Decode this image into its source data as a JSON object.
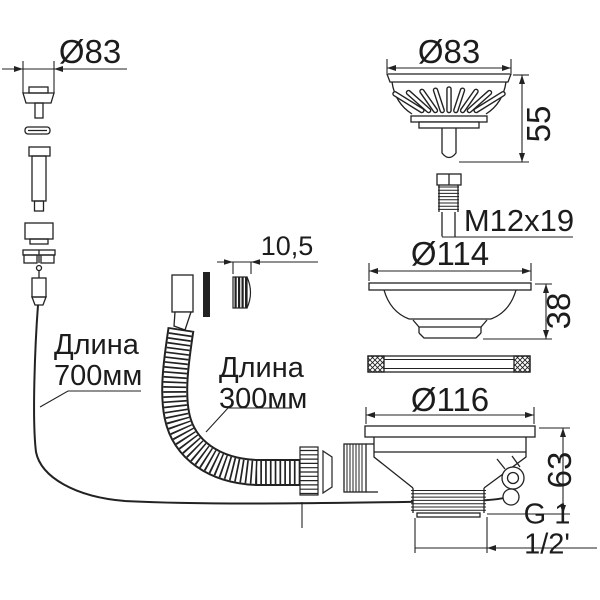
{
  "drawing": {
    "title_hint": "sink drain kit technical drawing",
    "background_color": "#ffffff",
    "line_color": "#222222",
    "text_color": "#1c1c1c"
  },
  "labels": {
    "dim_cap_diameter": "Ø83",
    "dim_basket_diameter": "Ø83",
    "dim_basket_height": "55",
    "dim_screw_thread": "M12x19",
    "dim_flange_diameter": "Ø114",
    "dim_flange_height": "38",
    "dim_body_diameter": "Ø116",
    "dim_body_height": "63",
    "dim_outlet_thread": "G 1 1/2'",
    "dim_hose_olive": "10,5",
    "overflow_hose_length": "Длина\n700мм",
    "corrugated_hose_length": "Длина\n300мм"
  }
}
